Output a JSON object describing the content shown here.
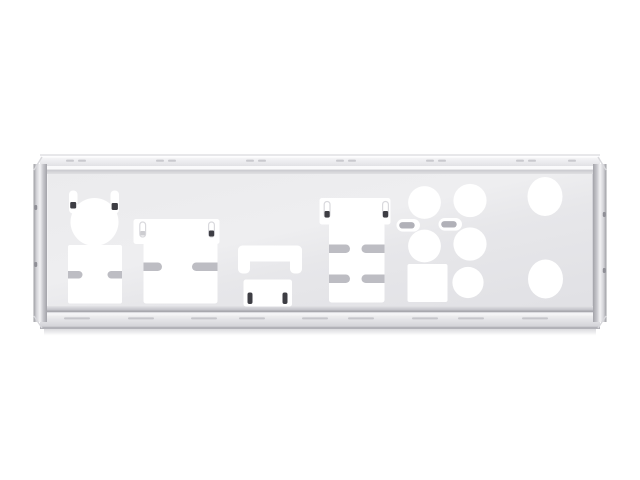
{
  "scene": {
    "background_color": "#ffffff",
    "object": "motherboard-io-shield-backplate",
    "orientation": "horizontal",
    "finish": "polished-chrome"
  },
  "colors": {
    "cutout_white": "#ffffff",
    "plate_face": "#e8e9eb",
    "plate_highlight": "#fafafc",
    "edge_dark_line": "#a8a8ae",
    "bevel_dark": "#9b9ca1",
    "tab_gray": "#bdbdc3",
    "lance_bar_gray": "#b1b1b8",
    "ear_outline_gray": "#d9d9dd",
    "fold_mark_dark": "#3e3e44",
    "dimple_gray": "#c9c9ce",
    "drop_shadow": "#a0a0a8"
  },
  "cutouts": {
    "ps2_port": {
      "count": 1,
      "shape": "circle-with-two-spring-slots"
    },
    "usb_double_stack": {
      "count": 1,
      "shape": "rect-with-two-side-tabs"
    },
    "vga_connector": {
      "count": 1,
      "shape": "stepped-rect-with-two-side-tabs"
    },
    "display_connector": {
      "count": 1,
      "shape": "bridge-slot-with-sub-window"
    },
    "lan_usb_tower": {
      "count": 1,
      "shape": "stepped-rect-with-four-side-tabs"
    },
    "audio_jacks": {
      "count": 5,
      "shape": "circle"
    },
    "optical_spdif": {
      "count": 1,
      "shape": "square"
    },
    "antenna_holes": {
      "count": 2,
      "shape": "round"
    },
    "spring_lance_slots": {
      "count": 2,
      "shape": "stadium-with-metal-bar"
    }
  }
}
